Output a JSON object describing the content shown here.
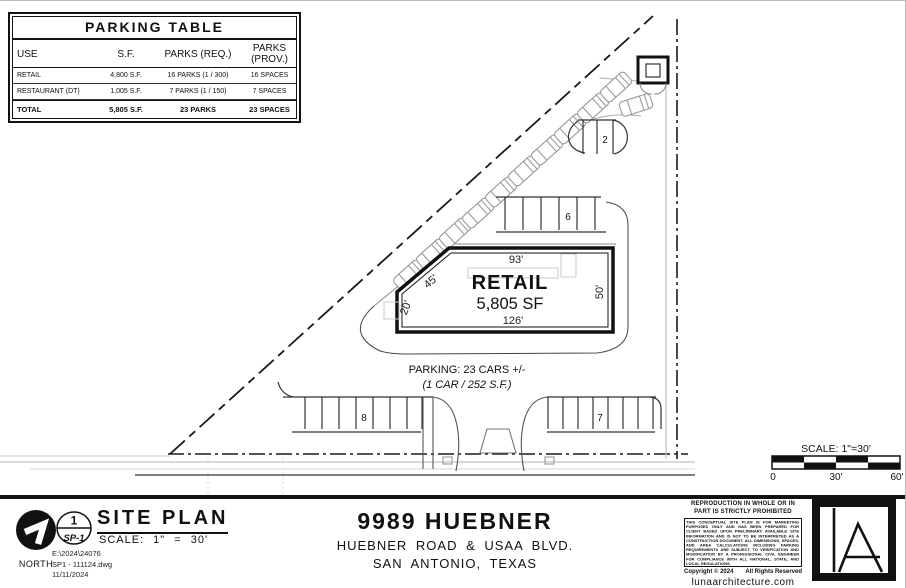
{
  "parking_table": {
    "title": "PARKING TABLE",
    "headers": [
      "USE",
      "S.F.",
      "PARKS (REQ.)",
      "PARKS (PROV.)"
    ],
    "rows": [
      [
        "RETAIL",
        "4,800 S.F.",
        "16 PARKS (1 / 300)",
        "16 SPACES"
      ],
      [
        "RESTAURANT (DT)",
        "1,005 S.F.",
        "7 PARKS (1 / 150)",
        "7 SPACES"
      ],
      [
        "TOTAL",
        "5,805 S.F.",
        "23 PARKS",
        "23 SPACES"
      ]
    ]
  },
  "site_plan": {
    "building": {
      "name": "RETAIL",
      "area": "5,805 SF",
      "dim_top": "93'",
      "dim_bottom": "126'",
      "dim_right": "50'",
      "dim_chamfer": "45'",
      "dim_left": "20'"
    },
    "parking_note": "PARKING: 23 CARS +/-",
    "parking_ratio": "(1 CAR / 252 S.F.)",
    "stall_counts": {
      "top": "2",
      "middle": "6",
      "bottom_left": "8",
      "bottom_right": "7"
    }
  },
  "graphic_scale": {
    "label": "SCALE:  1\"=30'",
    "tick0": "0",
    "tick1": "30'",
    "tick2": "60'"
  },
  "title_block": {
    "north_label": "NORTH",
    "detail_number": "1",
    "sheet_number": "SP-1",
    "title": "SITE PLAN",
    "scale": "SCALE: 1\" = 30'",
    "file_line1": "E:\\2024\\24076",
    "file_line2": "SP1 - 111124.dwg",
    "file_line3": "11/11/2024",
    "project_title": "9989 HUEBNER",
    "project_address1": "HUEBNER ROAD & USAA BLVD.",
    "project_address2": "SAN ANTONIO, TEXAS",
    "disclaimer_header": "REPRODUCTION IN WHOLE OR IN PART IS STRICTLY PROHIBITED",
    "disclaimer_body": "THIS CONCEPTUAL SITE PLAN IS FOR MARKETING PURPOSES ONLY AND HAS BEEN PREPARED FOR CLIENT BASED UPON PRELIMINARY AVAILABLE SITE INFORMATION AND IS NOT TO BE INTERPRETED AS A CONSTRUCTION DOCUMENT. ALL DIMENSIONS, SPACES, AND AREA CALCULATIONS INCLUDING PARKING REQUIREMENTS ARE SUBJECT TO VERIFICATION AND MODIFICATION BY A PROFESSIONAL CIVIL ENGINEER FOR COMPLIANCE WITH ALL NATIONAL, STATE, AND LOCAL REGULATIONS.",
    "copyright": "Copyright © 2024",
    "rights": "All Rights Reserved",
    "website": "lunaarchitecture.com"
  }
}
